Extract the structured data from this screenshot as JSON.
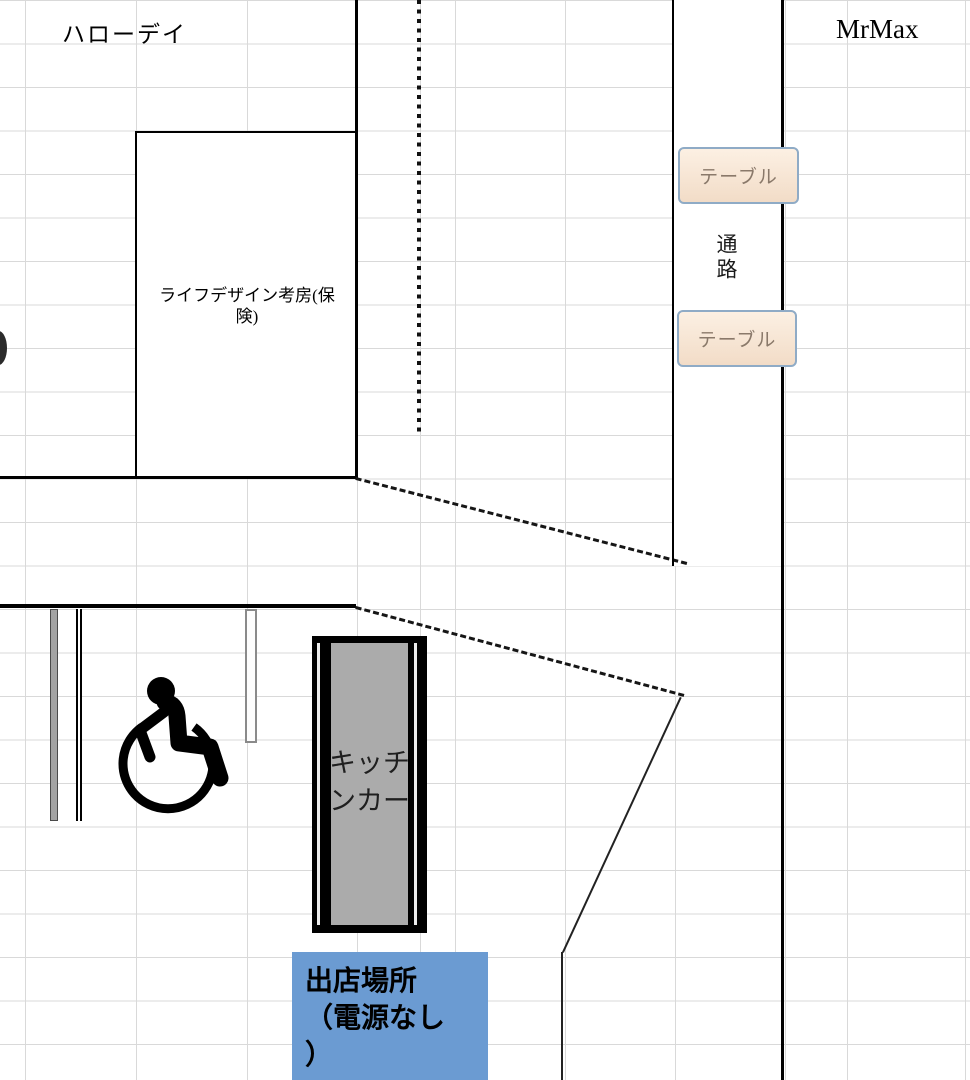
{
  "map": {
    "stores": {
      "left_store_label": "ハローデイ",
      "right_store_label": "MrMax"
    },
    "tenant": {
      "label": "ライフデザイン考房(保険)"
    },
    "aisle": {
      "label": "通路"
    },
    "tables": {
      "top_label": "テーブル",
      "bottom_label": "テーブル"
    },
    "kitchen_car": {
      "lines": [
        "キッチ",
        "ンカー"
      ]
    },
    "spot": {
      "lines": [
        "出店場所",
        "（電源なし",
        "）"
      ]
    },
    "icons": {
      "wheelchair": "wheelchair-accessible-symbol"
    },
    "colors": {
      "grid": "#d9d9d9",
      "table_fill": "#f7e4d1",
      "table_border": "#8fabc6",
      "table_text": "#8a796a",
      "spot_fill": "#6b9bd2",
      "kitchen_fill": "#ababab",
      "line": "#000000"
    }
  }
}
